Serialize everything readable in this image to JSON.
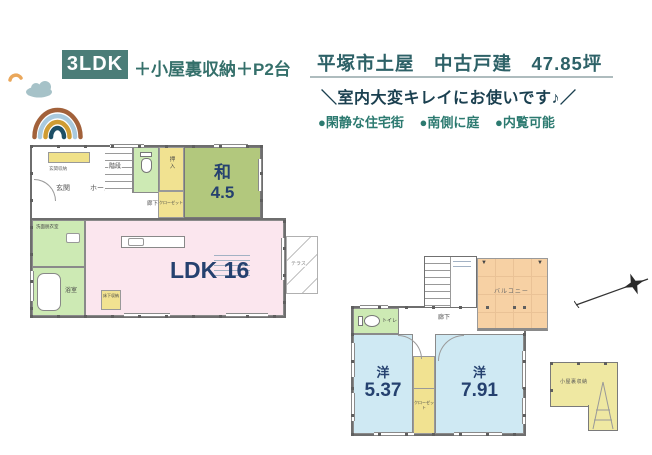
{
  "header": {
    "type_badge": "3LDK",
    "type_suffix": "＋小屋裏収納＋P2台",
    "title": "平塚市土屋　中古戸建　47.85坪",
    "subtitle": "＼室内大変キレイにお使いです♪／",
    "features": [
      "●閑静な住宅街",
      "●南側に庭",
      "●内覧可能"
    ]
  },
  "floor1": {
    "wa": {
      "label": "和",
      "area": "4.5"
    },
    "ldk": {
      "label": "LDK 16"
    },
    "genkan": "玄関",
    "hall": "ホール",
    "stairs": "階段",
    "corridor": "廊下",
    "oshiire": "押入",
    "closet": "クローゼット",
    "washroom": "洗面脱衣室",
    "bath": "浴室",
    "shoe_storage": "玄関収納",
    "floor_storage": "床下収納",
    "terrace": "テラス"
  },
  "floor2": {
    "yo1": {
      "label": "洋",
      "area": "5.37"
    },
    "yo2": {
      "label": "洋",
      "area": "7.91"
    },
    "toilet": "トイレ",
    "corridor": "廊下",
    "closet": "クローゼット",
    "balcony": "バルコニー"
  },
  "attic": {
    "label": "小屋裏収納"
  },
  "colors": {
    "badge_bg": "#4b7d78",
    "accent_teal": "#2c7a70",
    "title": "#2d6167",
    "subtitle": "#1b4050",
    "room_number": "#25416f",
    "ldk_pink": "#fbe6ee",
    "wa_green": "#b2c87d",
    "western_blue": "#cfe9f3",
    "closet_yellow": "#f1e291",
    "sanitary_green": "#cdeab4",
    "balcony_peach": "#f7d1a4",
    "attic_yellow": "#efe8a2"
  }
}
